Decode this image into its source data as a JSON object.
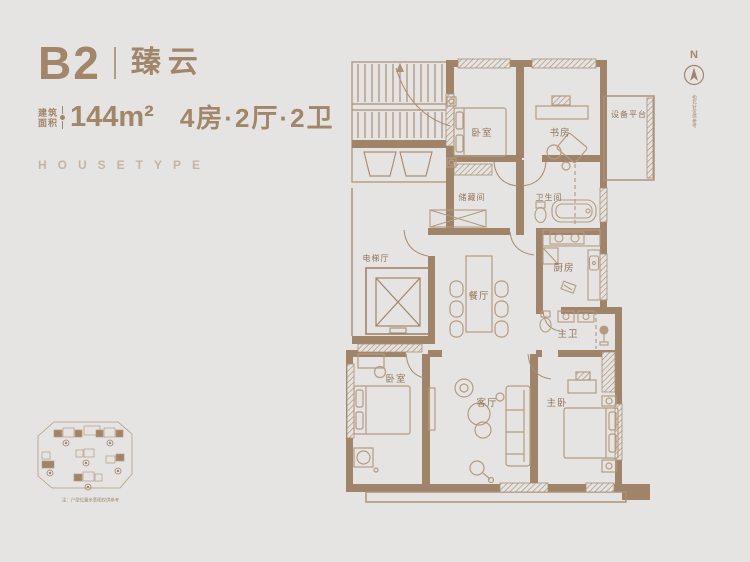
{
  "colors": {
    "background": "#e5e4e2",
    "accent": "#a1866a",
    "wall": "#a0846a",
    "thin_line": "#a98f75",
    "furniture_line": "#b49b80",
    "label": "#92755a"
  },
  "header": {
    "unit": "B2",
    "name": "臻云",
    "area_label": [
      "建筑",
      "面积"
    ],
    "area_value": "144m²",
    "layout_value": "4房·2厅·2卫",
    "watermark": "HOUSETYPE"
  },
  "compass": {
    "label": "N",
    "note": "指北针仅供参考"
  },
  "floorplan": {
    "rooms": [
      {
        "id": "bedroom-top",
        "label": "卧室"
      },
      {
        "id": "study",
        "label": "书房"
      },
      {
        "id": "equipment-platform",
        "label": "设备平台"
      },
      {
        "id": "storage",
        "label": "储藏间"
      },
      {
        "id": "bathroom",
        "label": "卫生间"
      },
      {
        "id": "elevator-hall",
        "label": "电梯厅"
      },
      {
        "id": "dining-room",
        "label": "餐厅"
      },
      {
        "id": "kitchen",
        "label": "厨房"
      },
      {
        "id": "master-bathroom",
        "label": "主卫"
      },
      {
        "id": "bedroom-bottom",
        "label": "卧室"
      },
      {
        "id": "living-room",
        "label": "客厅"
      },
      {
        "id": "master-bedroom",
        "label": "主卧"
      }
    ]
  },
  "siteplan": {
    "caption": "注：户型位置示意图仅供参考"
  }
}
